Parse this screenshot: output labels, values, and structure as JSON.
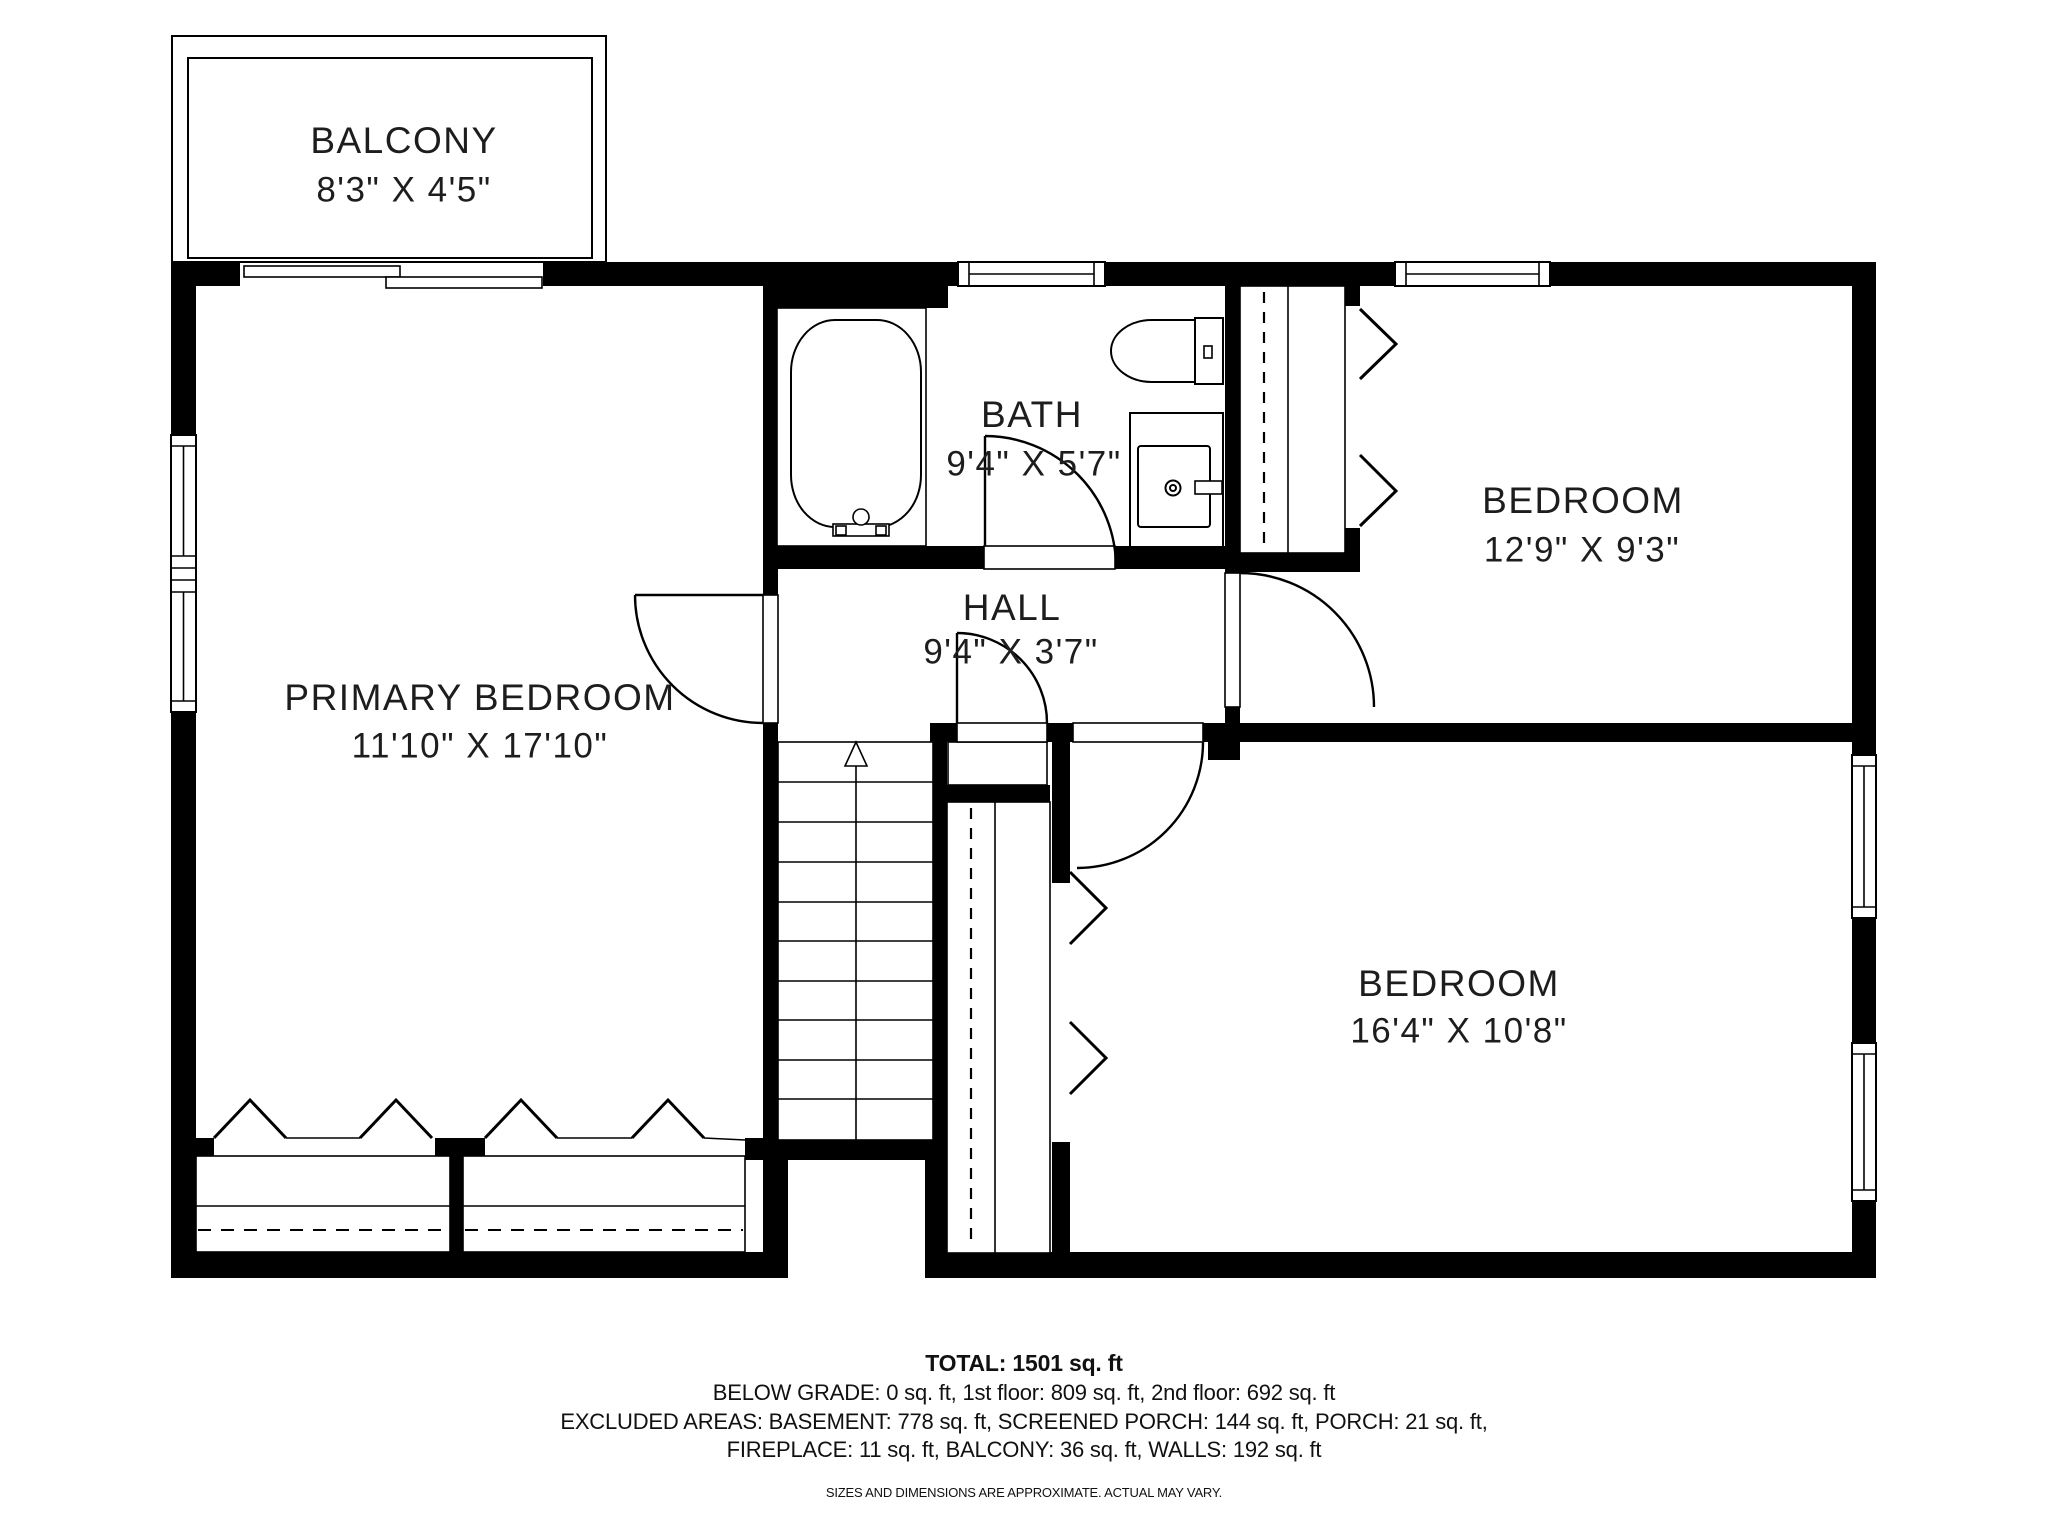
{
  "rooms": {
    "balcony": {
      "name": "BALCONY",
      "dims": "8'3\" X 4'5\""
    },
    "primary_bedroom": {
      "name": "PRIMARY BEDROOM",
      "dims": "11'10\" X 17'10\""
    },
    "bath": {
      "name": "BATH",
      "dims": "9'4\" X 5'7\""
    },
    "hall": {
      "name": "HALL",
      "dims": "9'4\" X 3'7\""
    },
    "bedroom_top_right": {
      "name": "BEDROOM",
      "dims": "12'9\" X 9'3\""
    },
    "bedroom_bottom_right": {
      "name": "BEDROOM",
      "dims": "16'4\" X 10'8\""
    }
  },
  "footer": {
    "total": "TOTAL: 1501 sq. ft",
    "line1": "BELOW GRADE: 0 sq. ft, 1st floor: 809 sq. ft, 2nd floor: 692 sq. ft",
    "line2": "EXCLUDED AREAS: BASEMENT: 778 sq. ft, SCREENED PORCH: 144 sq. ft, PORCH: 21 sq. ft,",
    "line3": "FIREPLACE: 11 sq. ft, BALCONY: 36 sq. ft, WALLS: 192 sq. ft",
    "disclaimer": "SIZES AND DIMENSIONS ARE APPROXIMATE. ACTUAL MAY VARY."
  },
  "colors": {
    "wall": "#000000",
    "line": "#1a1a1a",
    "text": "#1d1d1d",
    "background": "#ffffff"
  }
}
